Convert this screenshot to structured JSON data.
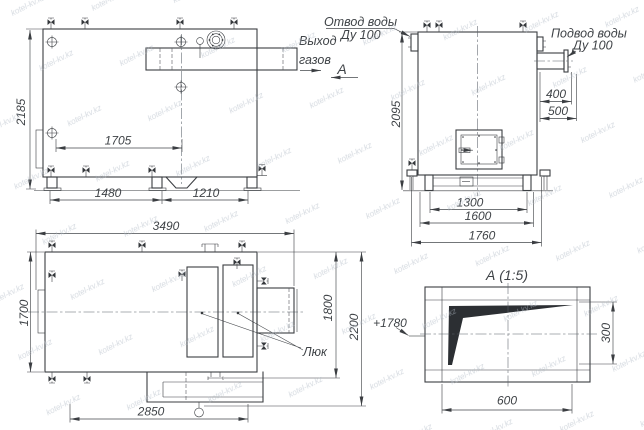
{
  "watermark": {
    "text": "kotel-kv.kz"
  },
  "front_view": {
    "gas_outlet_label": {
      "line1": "Выход",
      "line2": "газов"
    },
    "section_mark": "А",
    "dims": {
      "overall_height": "2185",
      "tube_bundle_length": "1705",
      "front_leg_span": "1480",
      "rear_leg_span": "1210"
    }
  },
  "side_view": {
    "water_outlet_label": {
      "line1": "Отвод воды",
      "line2": "Ду 100"
    },
    "water_inlet_label": {
      "line1": "Подвод воды",
      "line2": "Ду 100"
    },
    "dims": {
      "overall_height": "2095",
      "inlet_offset_top": "400",
      "inlet_offset_bottom": "500",
      "leg_span": "1300",
      "frame_width": "1600",
      "overall_width": "1760"
    }
  },
  "plan_view": {
    "hatch_label": "Люк",
    "flue_elevation": "+1780",
    "dims": {
      "overall_length": "3490",
      "body_width": "1700",
      "width_over_duct": "1800",
      "overall_width": "2200",
      "base_length": "2850"
    }
  },
  "detail_view": {
    "title": "А (1:5)",
    "dims": {
      "opening_width": "600",
      "opening_height": "300"
    }
  }
}
